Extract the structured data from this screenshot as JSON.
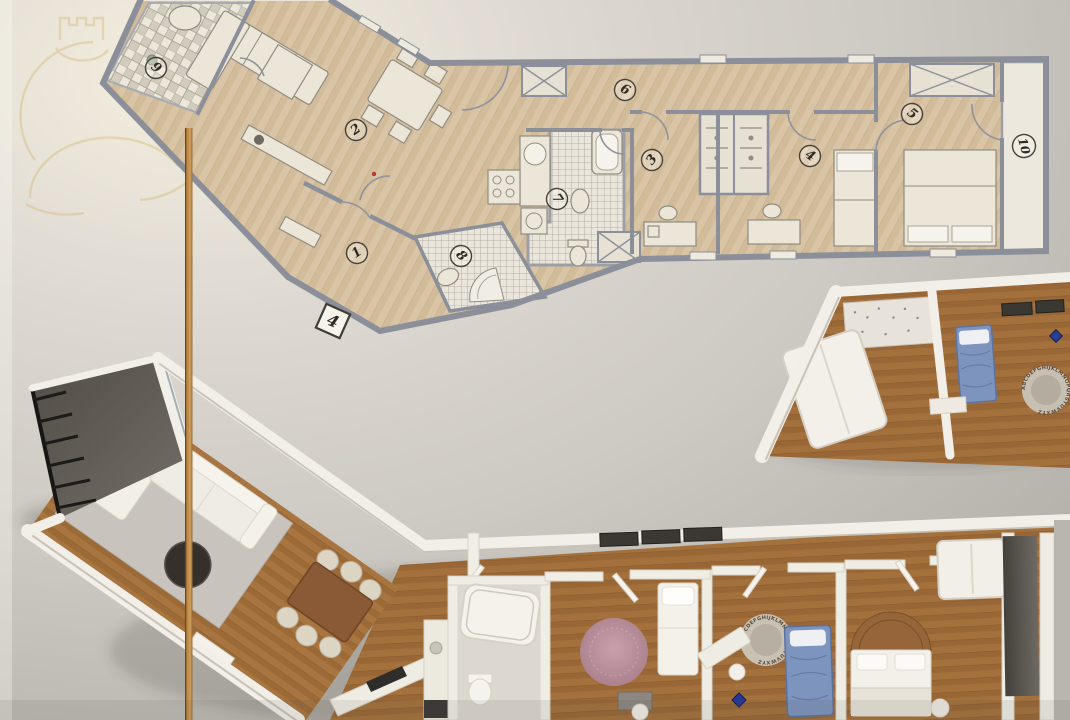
{
  "image": {
    "description": "Real-estate floor plan sheet: angled 2D apartment plan at top, 3D isometric render of the same apartment below, faint gold logo watermark top-left, vertical orange divider line"
  },
  "plan_2d": {
    "unit_badge": "4",
    "rooms": [
      {
        "number": "1",
        "name": "entrance-hall"
      },
      {
        "number": "2",
        "name": "living-dining-room"
      },
      {
        "number": "3",
        "name": "bedroom"
      },
      {
        "number": "4",
        "name": "bedroom"
      },
      {
        "number": "5",
        "name": "bedroom"
      },
      {
        "number": "6",
        "name": "corridor"
      },
      {
        "number": "7",
        "name": "bathroom"
      },
      {
        "number": "8",
        "name": "shower-room"
      },
      {
        "number": "9",
        "name": "balcony"
      },
      {
        "number": "10",
        "name": "balcony"
      }
    ]
  },
  "plan_3d": {
    "alphabet_rug_letters": "ABCDEFGHIJKLMNOPQRSTUVWXYZ"
  },
  "palette": {
    "background": "#cdc9c3",
    "background_light": "#f5efe0",
    "divider_orange": "#c08a45",
    "plan2d_floor": "#d9c5a6",
    "plan2d_wall": "#8b8f99",
    "tile": "#eae6dc",
    "wood3d": "#a8743f",
    "wall3d": "#f2efe8",
    "terrace": "#5a564f",
    "rug_gray": "#c8c4bd",
    "rug_pink": "#bb8f9a",
    "bed_blue": "#7d94be",
    "table_brown": "#8a5a36",
    "watermark_gold": "#cfae5c"
  }
}
